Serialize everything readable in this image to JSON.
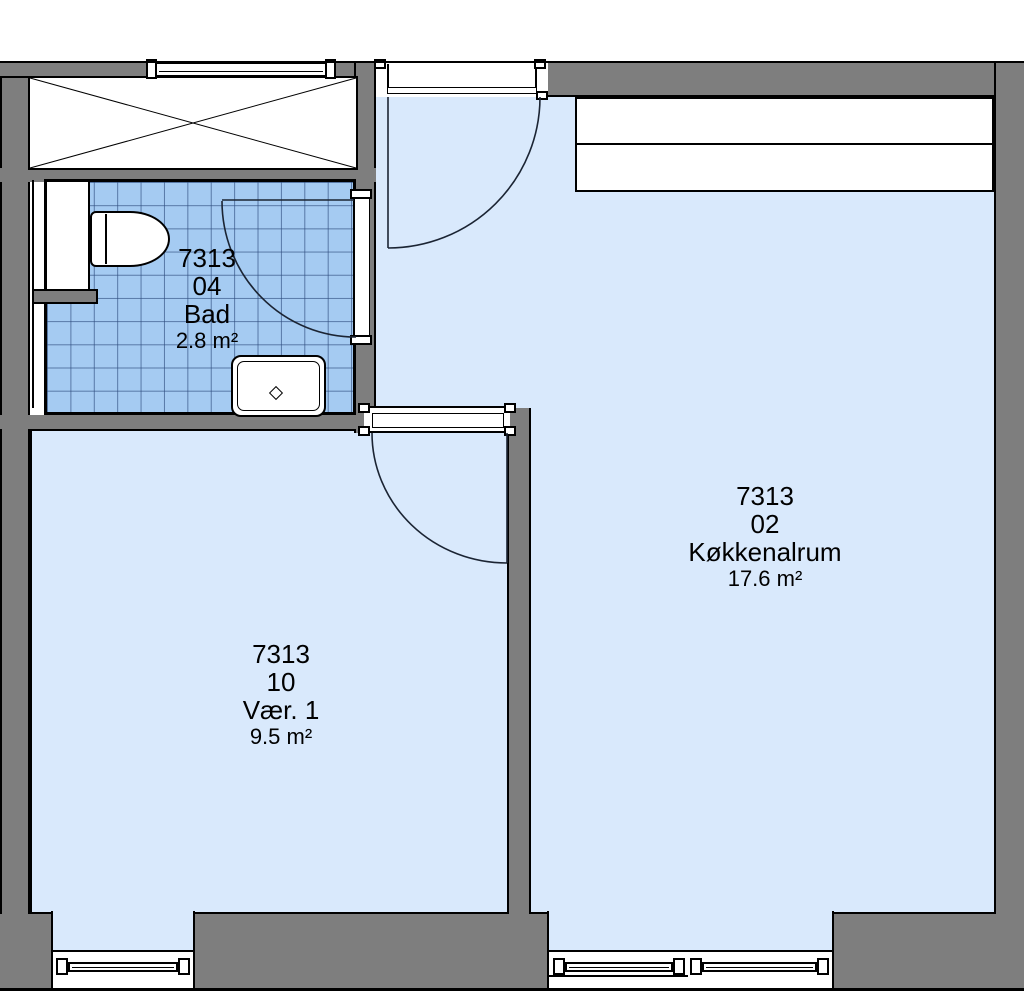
{
  "title": "Floor plan 7313",
  "colors": {
    "wall": "#7e7e7e",
    "floor": "#d9e9fc",
    "tile": "#a5cbf2",
    "tile_grid": "#2d4b7d",
    "outline": "#000000",
    "door_line": "#1b2433",
    "text": "#000000"
  },
  "rooms": [
    {
      "number": "7313",
      "unit": "04",
      "name": "Bad",
      "area": "2.8 m²"
    },
    {
      "number": "7313",
      "unit": "10",
      "name": "Vær. 1",
      "area": "9.5 m²"
    },
    {
      "number": "7313",
      "unit": "02",
      "name": "Køkkenalrum",
      "area": "17.6 m²"
    }
  ]
}
